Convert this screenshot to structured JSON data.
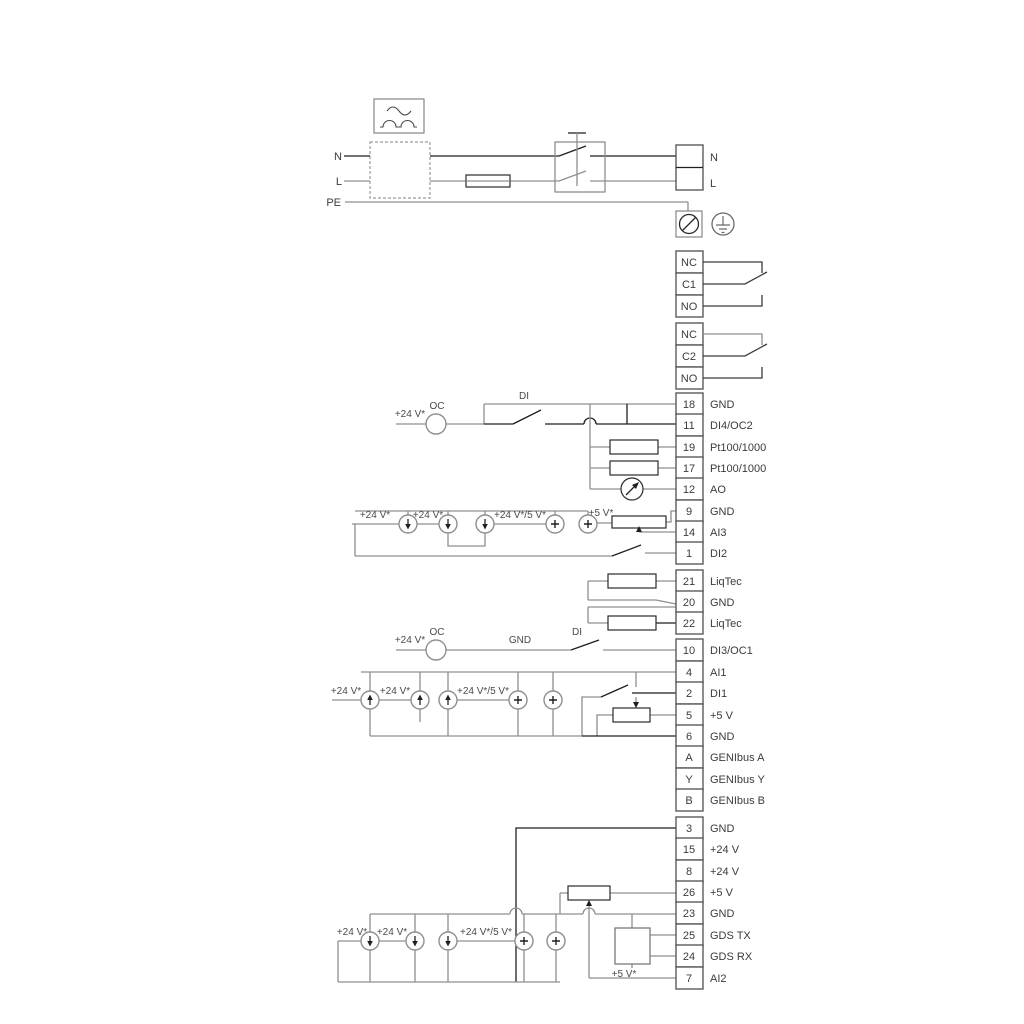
{
  "title": "Pump wiring diagram",
  "colors": {
    "wire_gray": "#8f8f8f",
    "wire_black": "#1f1f1f",
    "text": "#3b3b3b"
  },
  "power": {
    "n": "N",
    "l": "L",
    "pe": "PE",
    "term_n": "N",
    "term_l": "L"
  },
  "relays": {
    "r1": [
      "NC",
      "C1",
      "NO"
    ],
    "r2": [
      "NC",
      "C2",
      "NO"
    ]
  },
  "ann": {
    "oc": "OC",
    "di": "DI",
    "gnd": "GND",
    "v24": "+24 V*",
    "v245": "+24 V*/5 V*",
    "v5": "+5 V*"
  },
  "terminals": {
    "group1": [
      {
        "id": "18",
        "label": "GND"
      },
      {
        "id": "11",
        "label": "DI4/OC2"
      },
      {
        "id": "19",
        "label": "Pt100/1000"
      },
      {
        "id": "17",
        "label": "Pt100/1000"
      },
      {
        "id": "12",
        "label": "AO"
      },
      {
        "id": "9",
        "label": "GND"
      },
      {
        "id": "14",
        "label": "AI3"
      },
      {
        "id": "1",
        "label": "DI2"
      }
    ],
    "group2": [
      {
        "id": "21",
        "label": "LiqTec"
      },
      {
        "id": "20",
        "label": "GND"
      },
      {
        "id": "22",
        "label": "LiqTec"
      }
    ],
    "group3": [
      {
        "id": "10",
        "label": "DI3/OC1"
      },
      {
        "id": "4",
        "label": "AI1"
      },
      {
        "id": "2",
        "label": "DI1"
      },
      {
        "id": "5",
        "label": "+5 V"
      },
      {
        "id": "6",
        "label": "GND"
      },
      {
        "id": "A",
        "label": "GENIbus A"
      },
      {
        "id": "Y",
        "label": "GENIbus Y"
      },
      {
        "id": "B",
        "label": "GENIbus B"
      }
    ],
    "group4": [
      {
        "id": "3",
        "label": "GND"
      },
      {
        "id": "15",
        "label": "+24 V"
      },
      {
        "id": "8",
        "label": "+24 V"
      },
      {
        "id": "26",
        "label": "+5 V"
      },
      {
        "id": "23",
        "label": "GND"
      },
      {
        "id": "25",
        "label": "GDS TX"
      },
      {
        "id": "24",
        "label": "GDS RX"
      },
      {
        "id": "7",
        "label": "AI2"
      }
    ]
  }
}
